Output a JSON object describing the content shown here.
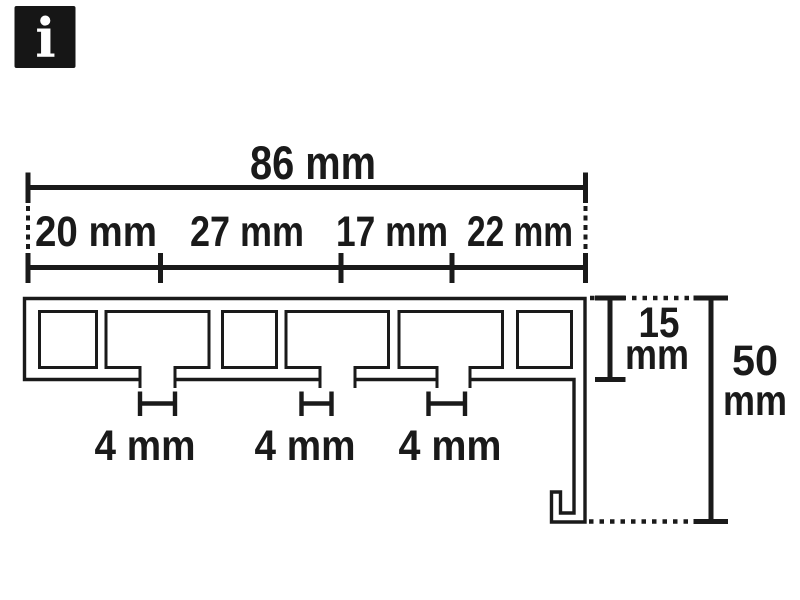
{
  "colors": {
    "background": "#ffffff",
    "line": "#1a1a1a",
    "icon_bg": "#161616",
    "icon_fg": "#ffffff"
  },
  "info_icon": {
    "glyph": "i"
  },
  "diagram": {
    "type": "technical-cross-section",
    "subject": "curtain track profile with three runner channels and side pelmet panel",
    "overall_width": {
      "label": "86 mm"
    },
    "segments": [
      {
        "label": "20 mm"
      },
      {
        "label": "27 mm"
      },
      {
        "label": "17 mm"
      },
      {
        "label": "22 mm"
      }
    ],
    "slots": [
      {
        "label": "4 mm"
      },
      {
        "label": "4 mm"
      },
      {
        "label": "4 mm"
      }
    ],
    "profile_height": {
      "value": "15",
      "unit": "mm"
    },
    "total_height": {
      "value": "50",
      "unit": "mm"
    }
  }
}
